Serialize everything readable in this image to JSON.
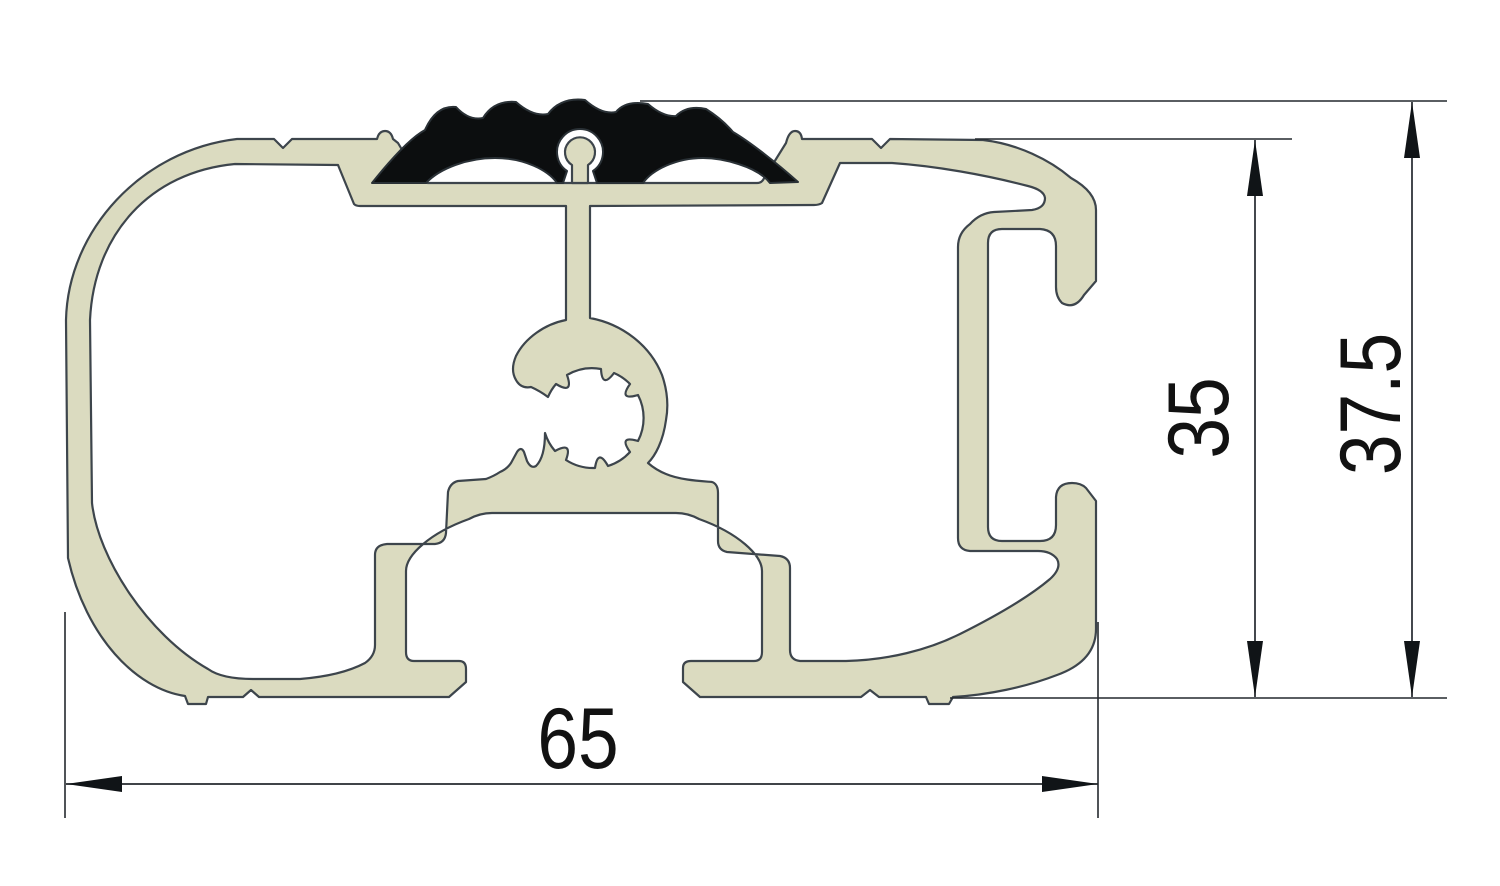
{
  "drawing": {
    "type": "technical-cross-section",
    "subject": "aluminium-profile-with-rubber-grip-insert",
    "dimensions": {
      "width": {
        "label": "65",
        "orientation": "horizontal"
      },
      "height_to_top_surface": {
        "label": "35",
        "orientation": "vertical"
      },
      "height_overall": {
        "label": "37.5",
        "orientation": "vertical"
      }
    },
    "colors": {
      "aluminum_fill": "#dbdbc0",
      "rubber_fill": "#0c0e0f",
      "outline": "#3d454c",
      "dimension_lines": "#24292e",
      "background": "#ffffff"
    }
  }
}
